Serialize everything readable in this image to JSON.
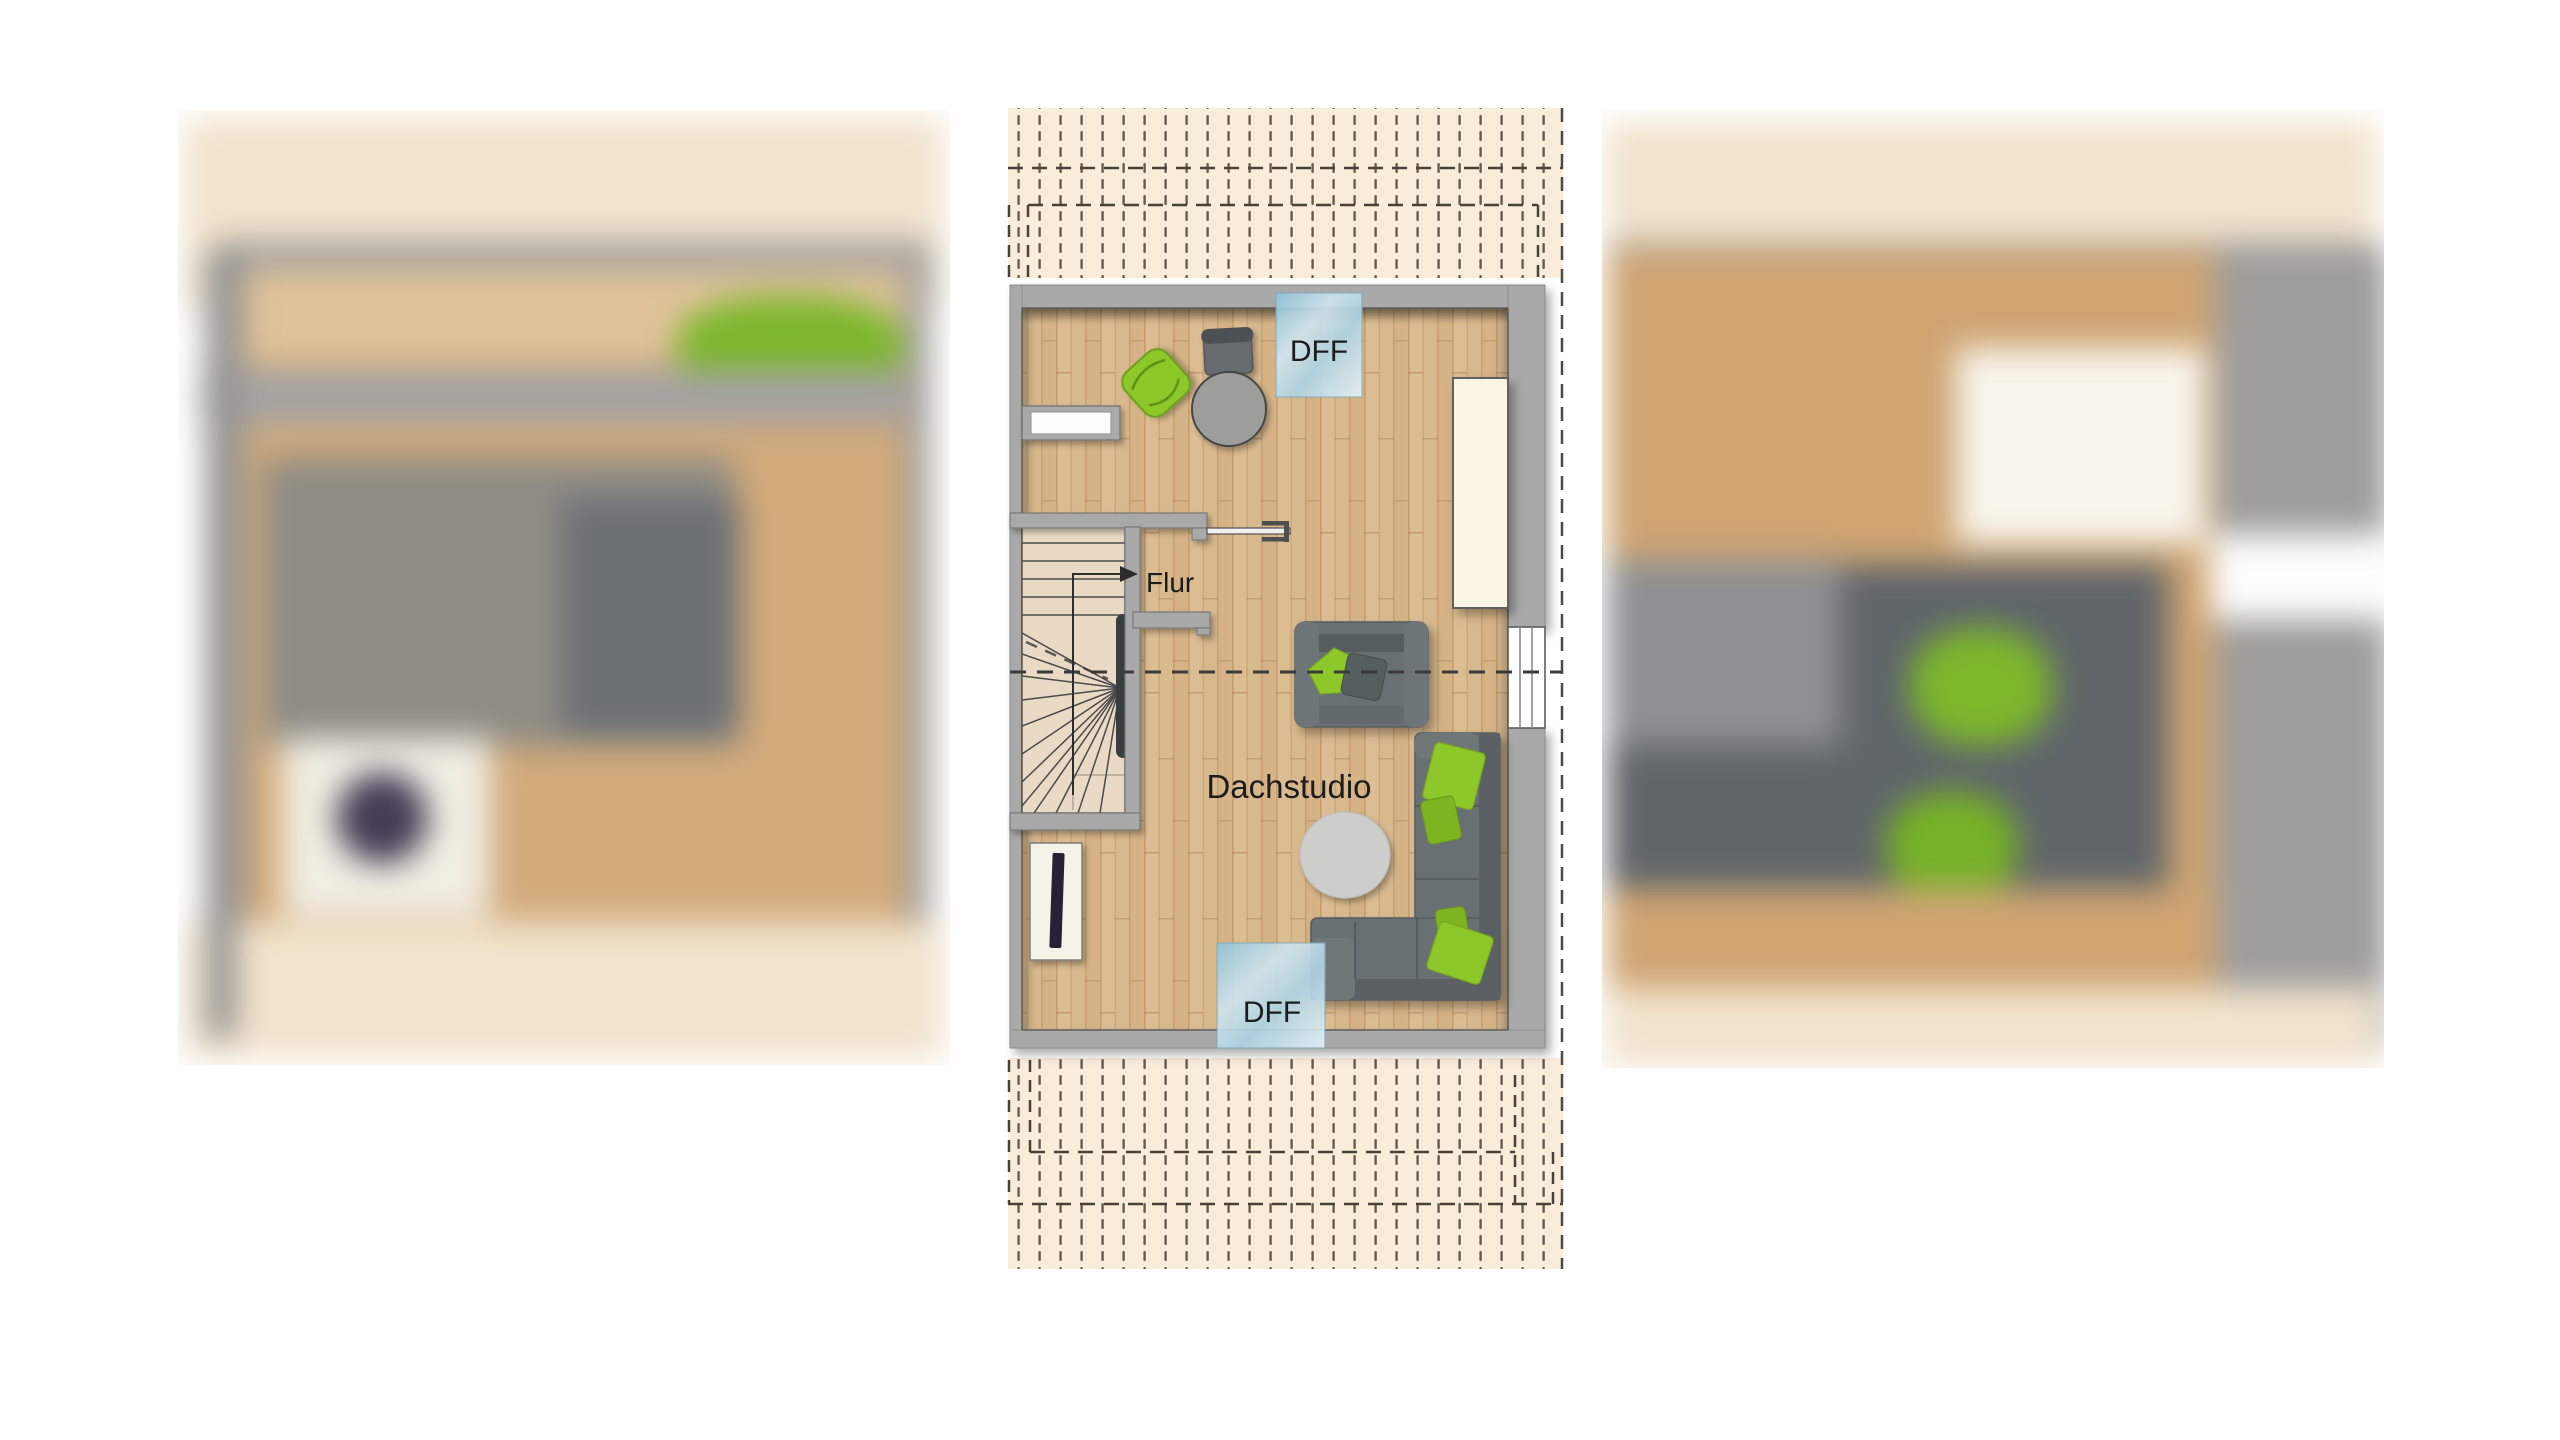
{
  "plan": {
    "room_label": "Dachstudio",
    "corridor_label": "Flur",
    "roof_window_top_label": "DFF",
    "roof_window_bottom_label": "DFF"
  },
  "colors": {
    "floor_wood": "#d8b88d",
    "wall_gray": "#a9a9a9",
    "roof_area_cream": "#f9ecd9",
    "dash_brown": "#4a4238",
    "sofa_gray": "#697073",
    "accent_lime": "#8ec72c",
    "skylight_blue": "#aed3e4",
    "label_text": "#1c1c1c"
  }
}
